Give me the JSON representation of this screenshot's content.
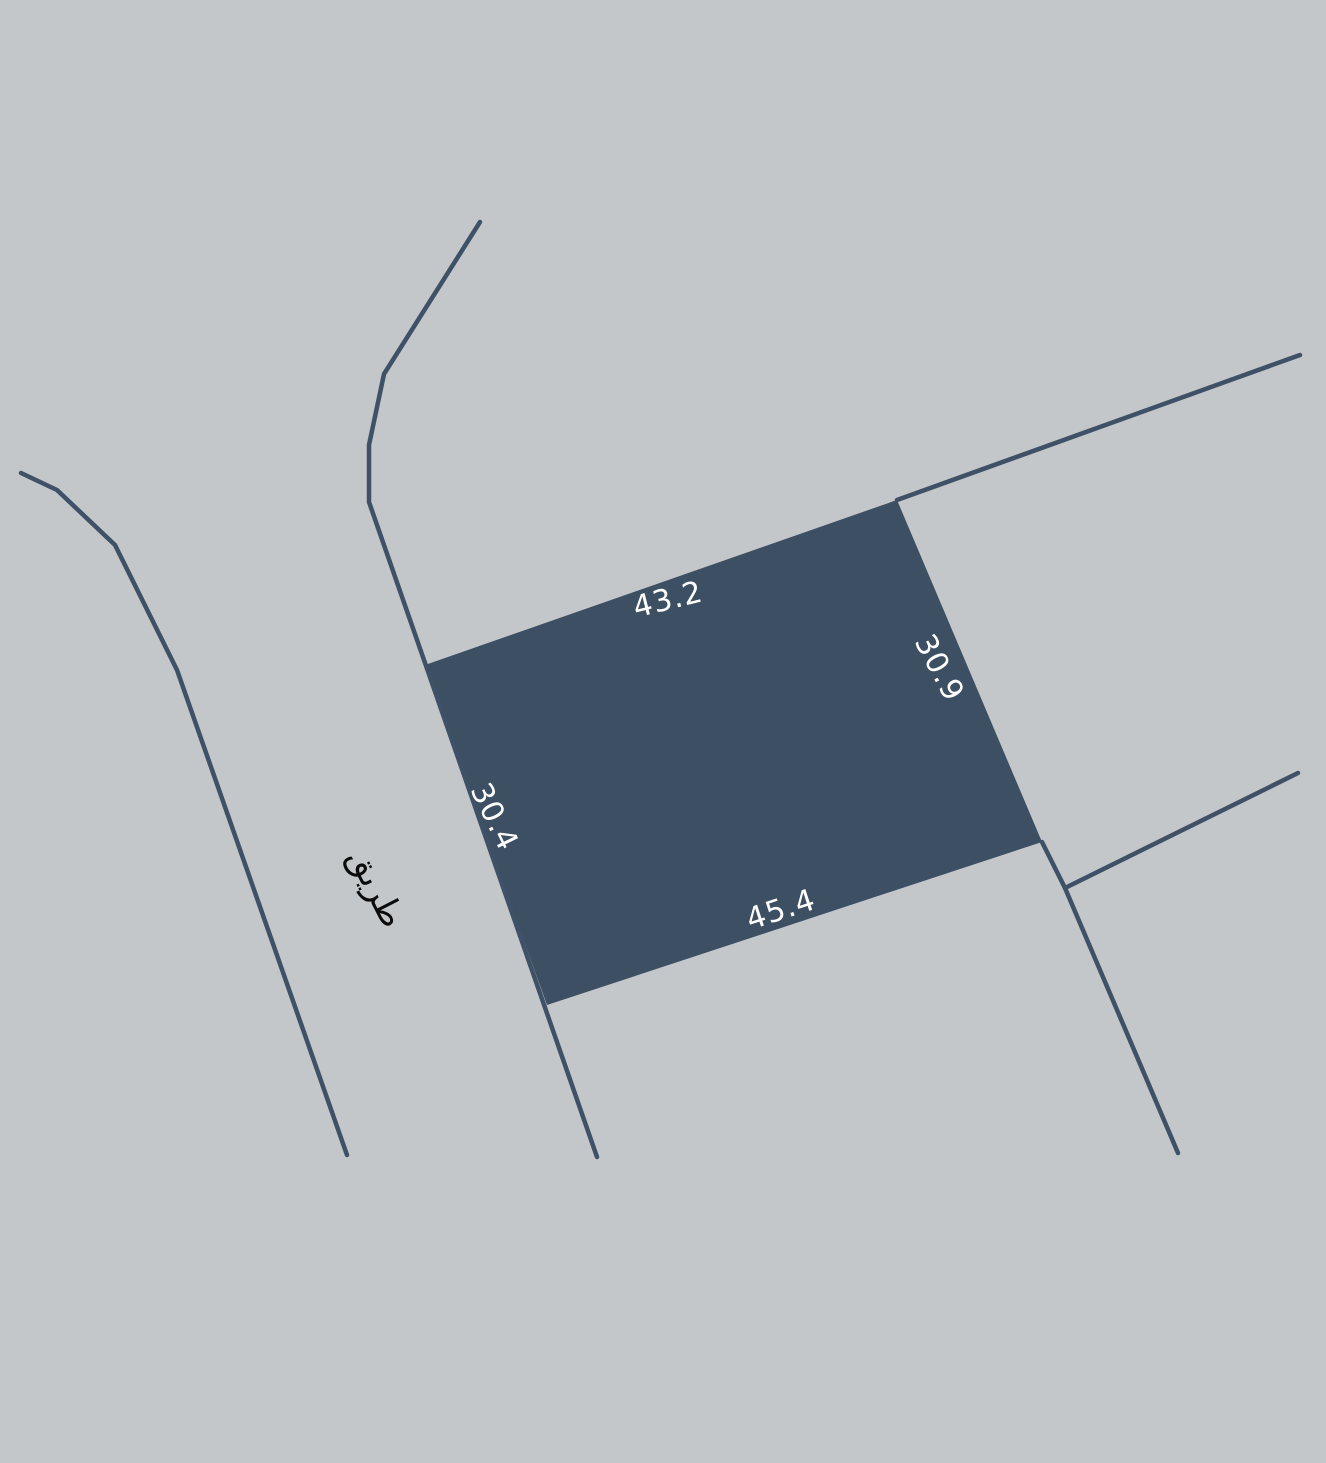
{
  "map": {
    "background_color": "#c3c7ca",
    "line_color": "#3e5166",
    "parcel": {
      "fill_color": "#3c4f63",
      "label_color": "#ffffff",
      "dimensions": {
        "top": "43.2",
        "right": "30.9",
        "bottom": "45.4",
        "left": "30.4"
      }
    },
    "road_label": {
      "text": "طريق",
      "color": "#0b0b0b"
    }
  }
}
